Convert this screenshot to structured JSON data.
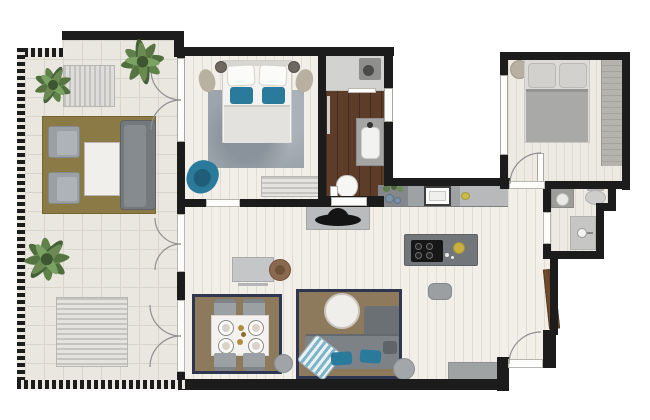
{
  "app": {
    "title": "apartment-floor-plan",
    "view": "top-down-3d-render"
  },
  "colors": {
    "wall": "#1c1c1c",
    "tile": "#eae7e0",
    "tileline": "#d9d5cb",
    "wood": "#f2efe8",
    "bath": "#5d3c29",
    "teal": "#2a7a9c",
    "olive": "#8b7a45",
    "navy": "#2e3650",
    "tan": "#8d7a5c",
    "graysofa": "#75797d",
    "grayfurn": "#9ba0a4",
    "island": "#72767a",
    "green": "#567442",
    "brown": "#6f4b2d",
    "yellow": "#c9b13e",
    "bedwhite": "#f4f3f0",
    "duvet": "#a9a9a7"
  },
  "rooms": [
    {
      "id": "terrace",
      "furniture": [
        "palm-plant",
        "palm-plant",
        "palm-plant",
        "garden-bench",
        "sun-lounger",
        "outdoor-rug",
        "armchair",
        "armchair",
        "coffee-table",
        "outdoor-sofa"
      ]
    },
    {
      "id": "bedroom-1",
      "furniture": [
        "double-bed",
        "pillow",
        "pillow",
        "teal-pillow",
        "teal-pillow",
        "nightstand",
        "nightstand",
        "pouf",
        "pouf",
        "area-rug",
        "teal-armchair",
        "storage-bench"
      ]
    },
    {
      "id": "bathroom-1",
      "furniture": [
        "walk-in-shower",
        "shower-head",
        "vanity-sink",
        "toilet",
        "towel-rail",
        "door-leaf"
      ]
    },
    {
      "id": "kitchen",
      "furniture": [
        "counter",
        "double-sink",
        "oven",
        "herb-pots",
        "kitchen-island",
        "cooktop",
        "fruit-bowl",
        "bar-stool"
      ]
    },
    {
      "id": "living-dining",
      "furniture": [
        "tv-console",
        "decor-hat",
        "desk",
        "desk-stool",
        "dining-rug",
        "dining-table",
        "plate",
        "plate",
        "plate",
        "plate",
        "dining-chair",
        "dining-chair",
        "dining-chair",
        "dining-chair",
        "pouf",
        "lounge-rug",
        "round-coffee-table",
        "corner-sofa",
        "striped-chaise",
        "teal-cushion",
        "teal-cushion",
        "pouf",
        "sideboard"
      ]
    },
    {
      "id": "bedroom-2",
      "furniture": [
        "double-bed",
        "pillow",
        "pillow",
        "wardrobe",
        "round-side-table",
        "door-leaf"
      ]
    },
    {
      "id": "bathroom-2",
      "furniture": [
        "vanity-sink",
        "toilet",
        "shower"
      ]
    },
    {
      "id": "hallway",
      "furniture": [
        "entrance-door",
        "tall-closet"
      ]
    }
  ],
  "openings": {
    "exterior_door_arcs": 3,
    "interior_door_arcs": 2,
    "windows": 3
  }
}
